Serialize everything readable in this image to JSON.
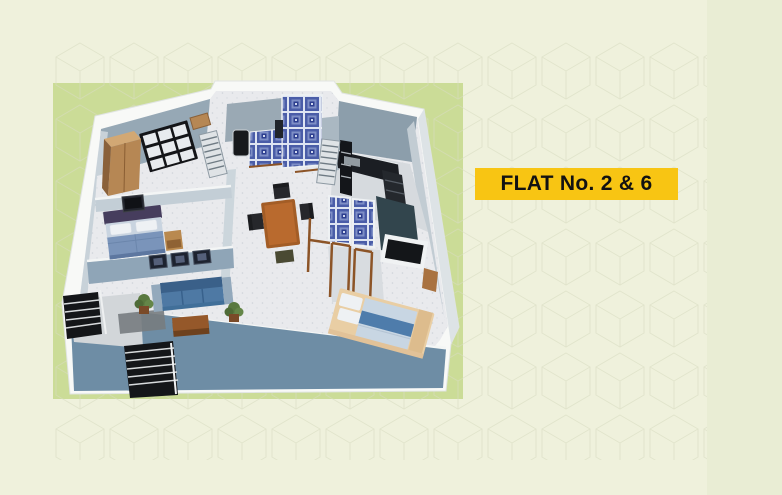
{
  "page": {
    "background_color": "#eff1dc",
    "right_panel_color": "#e9edd4",
    "accent_panel_color": "#cbdc97",
    "pattern_line_color": "#d9ddc2"
  },
  "badge": {
    "label": "FLAT No. 2 & 6",
    "background_color": "#f8c513",
    "text_color": "#121212"
  },
  "floorplan": {
    "description": "3D isometric floor plan render of flat",
    "palette": {
      "exterior_wall_front": "#6e8da5",
      "wall_top_trim": "#f8f9f7",
      "interior_wall": "#c3ced6",
      "floor": "#e9eaed",
      "bathroom_tile": "#4a5da8",
      "kitchen_counter": "#1b1e23",
      "wood": "#8c5427",
      "dining_table": "#b96a2e",
      "sofa": "#4e79a4",
      "bed_linen": "#7a94ba",
      "tan_bed": "#e9cea4",
      "stairs": "#141619"
    },
    "rooms": [
      {
        "name": "bedroom-top-left",
        "features": [
          "window-grill",
          "wardrobe",
          "dresser"
        ]
      },
      {
        "name": "bedroom-middle-left",
        "features": [
          "double-bed",
          "pillows",
          "nightstand",
          "tv-frame"
        ]
      },
      {
        "name": "living-room",
        "features": [
          "sofa",
          "wall-frames",
          "plants",
          "coffee-table",
          "floor-mat"
        ]
      },
      {
        "name": "dining-area",
        "features": [
          "dining-table",
          "chairs",
          "stool"
        ]
      },
      {
        "name": "kitchen",
        "features": [
          "black-counter",
          "appliance-stack",
          "sink",
          "louver-shutter"
        ]
      },
      {
        "name": "bathroom-top",
        "features": [
          "blue-tiled-walls",
          "geyser"
        ]
      },
      {
        "name": "bathroom-center",
        "features": [
          "blue-tiled-panels",
          "dark-wall",
          "window",
          "wood-door-frames"
        ]
      },
      {
        "name": "bedroom-bottom-right",
        "features": [
          "platform-bed",
          "blue-runner",
          "pillows",
          "side-shelf"
        ]
      },
      {
        "name": "stairwell",
        "features": [
          "stair-flight-left",
          "stair-flight-bottom",
          "railing"
        ]
      }
    ]
  }
}
